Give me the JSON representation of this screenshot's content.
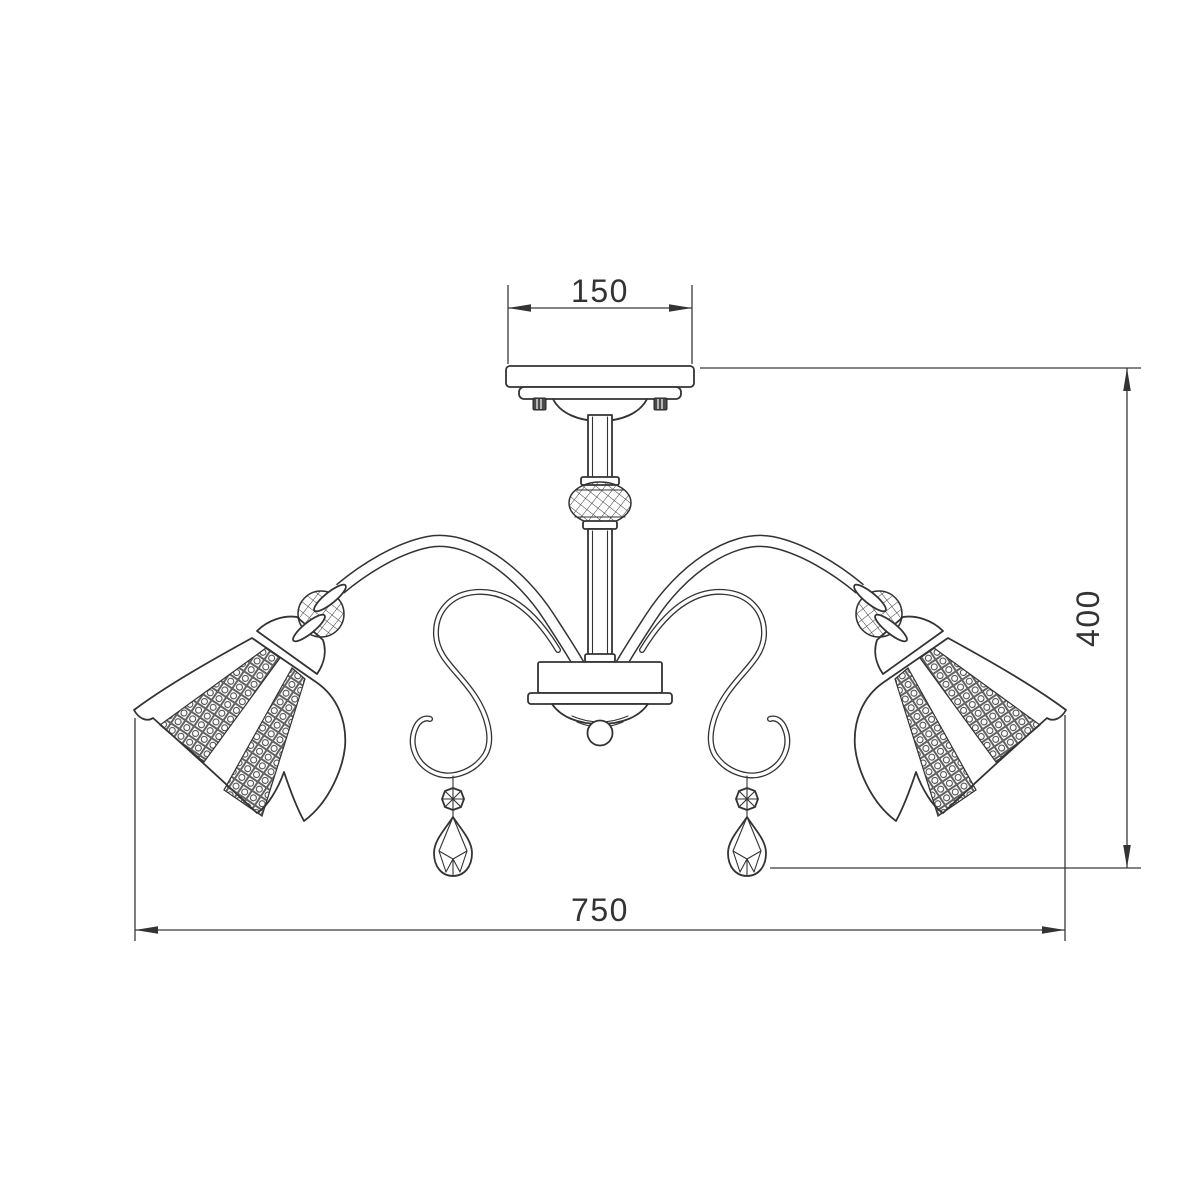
{
  "page": {
    "background_color": "#ffffff",
    "line_color": "#333333"
  },
  "drawing": {
    "title": "Chandelier technical drawing - front elevation",
    "type": "dimensioned line drawing",
    "dimensions": {
      "canopy_width": {
        "label": "150",
        "orientation": "horizontal",
        "location": "top"
      },
      "height": {
        "label": "400",
        "orientation": "vertical",
        "location": "right"
      },
      "overall_width": {
        "label": "750",
        "orientation": "horizontal",
        "location": "bottom"
      }
    }
  }
}
